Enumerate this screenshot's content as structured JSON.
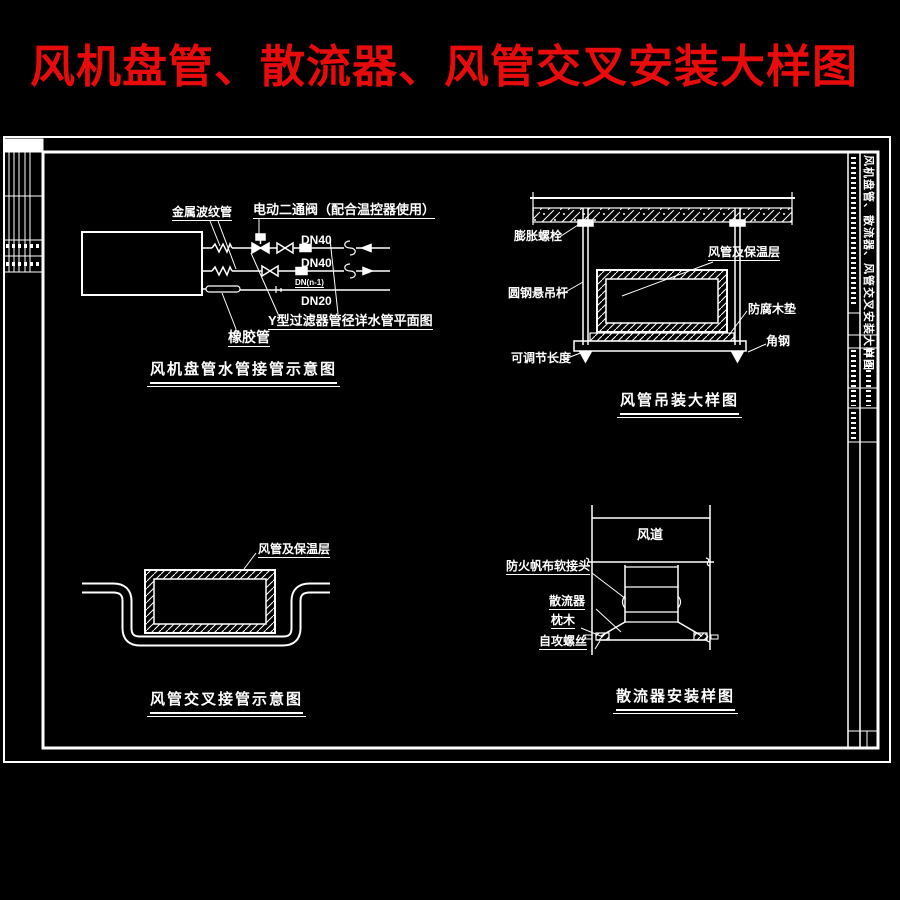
{
  "title": {
    "text": "风机盘管、散流器、风管交叉安装大样图"
  },
  "colors": {
    "background": "#000000",
    "line": "#ffffff",
    "title_red": "#e80b0b"
  },
  "details": {
    "fcu": {
      "caption": "风机盘管水管接管示意图",
      "labels": {
        "metal_hose": "金属波纹管",
        "electric_valve": "电动二通阀（配合温控器使用）",
        "rubber_hose": "橡胶管",
        "strainer_note": "Y型过滤器管径详水管平面图",
        "slope_note": "DN(n-1)"
      },
      "pipes": [
        {
          "size": "DN40"
        },
        {
          "size": "DN40"
        },
        {
          "size": "DN20"
        }
      ]
    },
    "hanging": {
      "caption": "风管吊装大样图",
      "labels": {
        "expansion_bolt": "膨胀螺栓",
        "duct_insulation": "风管及保温层",
        "rod": "圆钢悬吊杆",
        "wood_pad": "防腐木垫",
        "angle_steel": "角钢",
        "adjustable": "可调节长度"
      }
    },
    "crossing": {
      "caption": "风管交叉接管示意图",
      "labels": {
        "duct_insulation": "风管及保温层"
      }
    },
    "diffuser": {
      "caption": "散流器安装样图",
      "labels": {
        "duct": "风道",
        "flex_joint": "防火帆布软接头",
        "diffuser": "散流器",
        "wood_block": "枕木",
        "screw": "自攻螺丝"
      }
    }
  },
  "title_block": {
    "vertical_title": "风机盘管、散流器、风管交叉安装大样图"
  }
}
